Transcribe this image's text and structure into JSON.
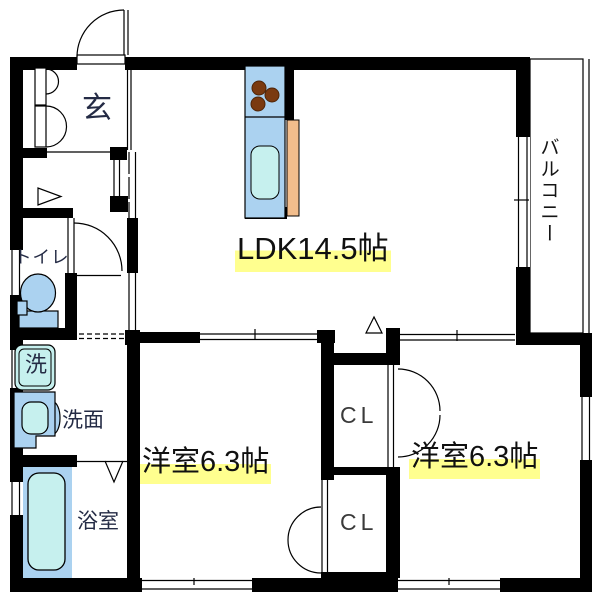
{
  "floor_plan": {
    "kind": "japanese-apartment-floor-plan",
    "layout_type": "2LDK",
    "labels": {
      "genkan": "玄",
      "toilet": "トイレ",
      "washer": "洗",
      "washroom": "洗面",
      "bathroom": "浴室",
      "ldk": "LDK14.5帖",
      "bedroom_left": "洋室6.3帖",
      "bedroom_right": "洋室6.3帖",
      "closet_upper": "CL",
      "closet_lower": "CL",
      "balcony": "バルコニー"
    },
    "areas_tatami": {
      "ldk": 14.5,
      "bedroom_left": 6.3,
      "bedroom_right": 6.3
    },
    "colors": {
      "wall": "#000000",
      "background": "#ffffff",
      "fixture_blue": "#abd2f0",
      "fixture_cyan": "#c6f0ee",
      "counter_orange": "#f2bd8c",
      "burner_brown": "#7a3a10",
      "highlight_yellow": "#ffff8f"
    }
  }
}
